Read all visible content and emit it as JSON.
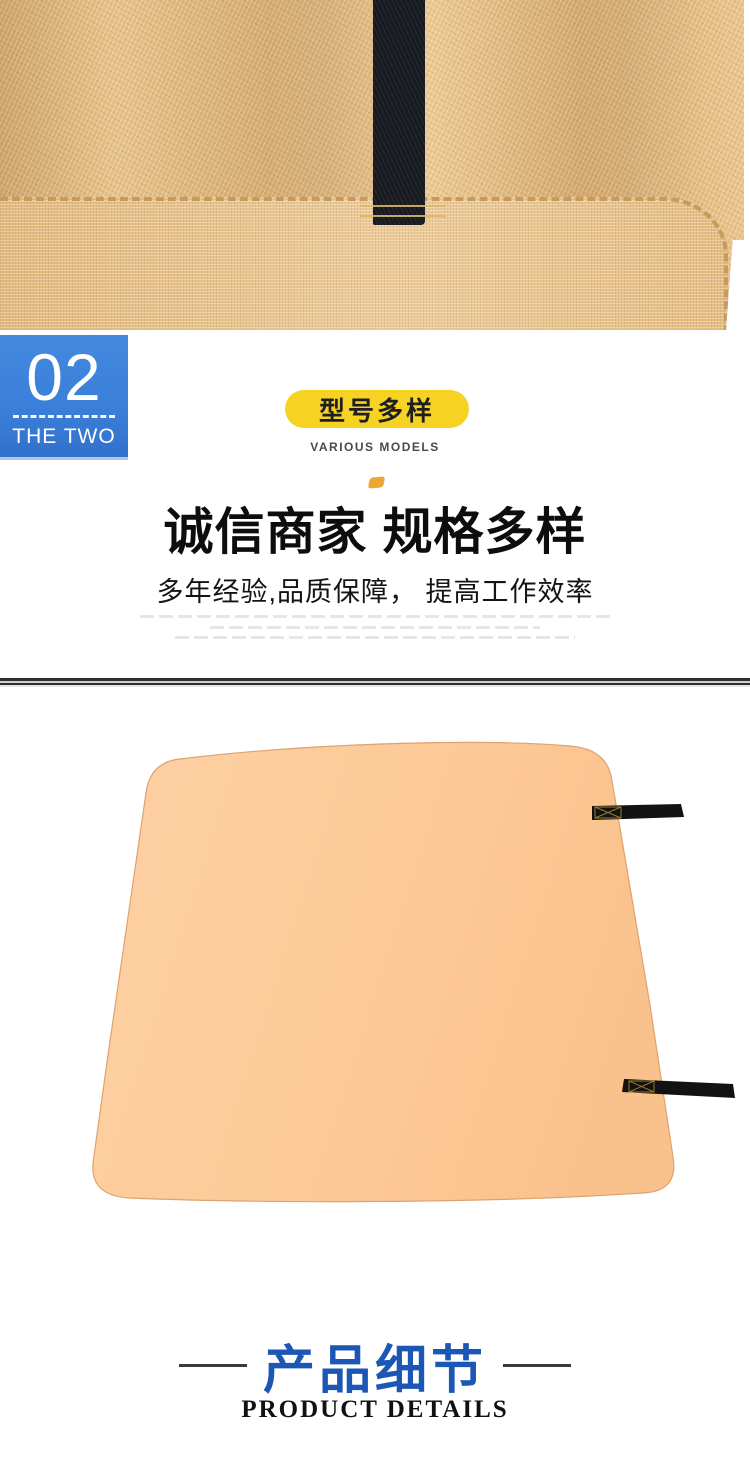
{
  "photo": {
    "description": "tan woven fabric blanket with black hanging strap",
    "fabric_color": "#dfb479",
    "fabric_light_color": "#ecc991",
    "strap_color": "#171a20",
    "stitch_color": "#d9b56c"
  },
  "section_badge": {
    "number": "02",
    "label": "THE TWO",
    "color": "#3a7fd9"
  },
  "model_pill": {
    "label": "型号多样",
    "sublabel": "VARIOUS MODELS",
    "pill_color": "#f6d322"
  },
  "headline": {
    "title": "诚信商家 规格多样",
    "subtitle": "多年经验,品质保障， 提高工作效率",
    "accent_color": "#efa636"
  },
  "product_image": {
    "description": "peach colored square mat with two black side straps",
    "mat_color": "#fdca98",
    "mat_edge_color": "#dca36f",
    "strap_color": "#121212",
    "strap_stitch_color": "#9a7a2e"
  },
  "details_header": {
    "title": "产品细节",
    "subtitle": "PRODUCT DETAILS",
    "title_color": "#1c57b5"
  }
}
